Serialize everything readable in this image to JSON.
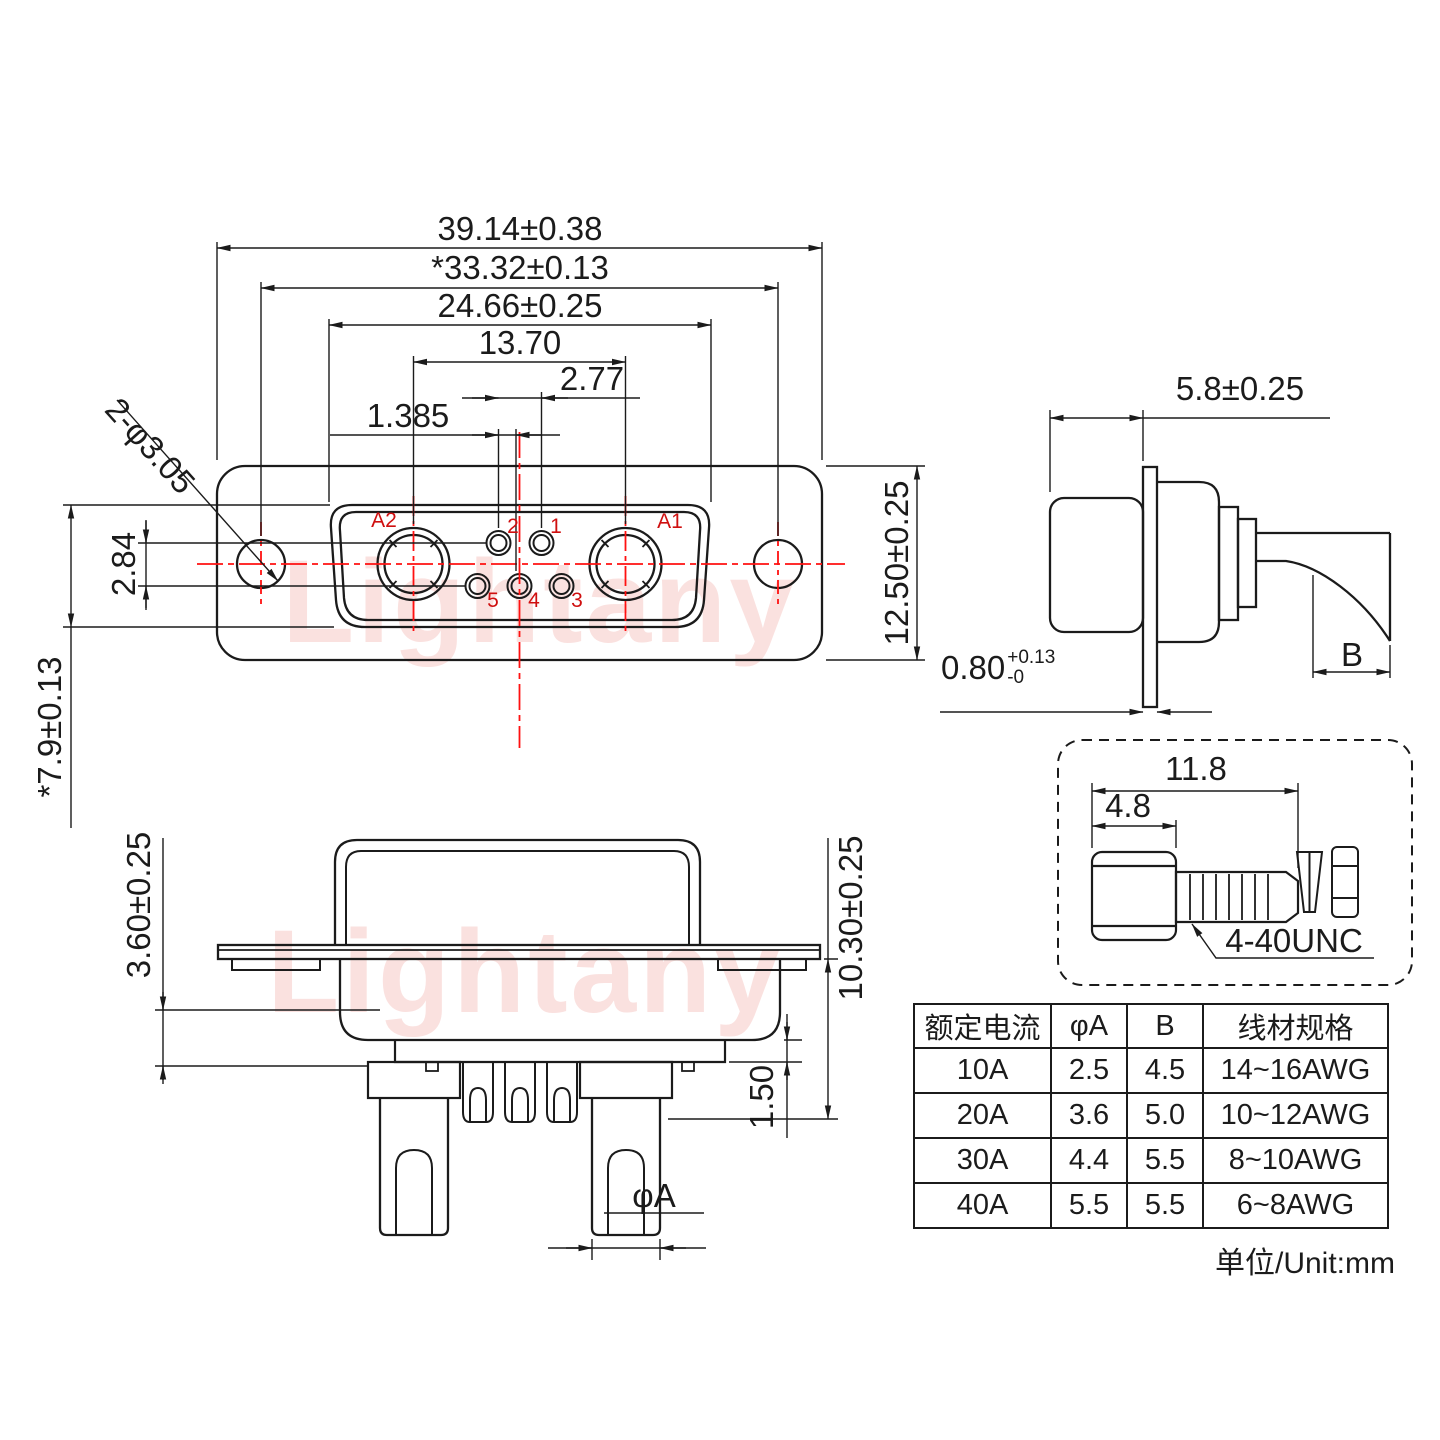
{
  "meta": {
    "watermark": "Lightany",
    "unit_note": "单位/Unit:mm"
  },
  "front_view": {
    "label_overall_width": "39.14±0.38",
    "label_mount_span": "*33.32±0.13",
    "label_shell_width": "24.66±0.25",
    "label_power_pitch": "13.70",
    "label_signal_pitch": "2.77",
    "label_signal_offset": "1.385",
    "label_mount_hole": "2-φ3.05",
    "label_row_gap": "2.84",
    "label_shell_height": "*7.9±0.13",
    "label_flange_height": "12.50±0.25",
    "pin_labels": {
      "a2": "A2",
      "a1": "A1",
      "p1": "1",
      "p2": "2",
      "p3": "3",
      "p4": "4",
      "p5": "5"
    }
  },
  "side_view": {
    "label_depth": "5.8±0.25",
    "label_flange_thickness": "0.80",
    "label_tol_plus": "+0.13",
    "label_tol_minus": "-0",
    "label_tail": "B"
  },
  "bottom_view": {
    "label_insulator_depth": "3.60±0.25",
    "label_total_depth": "10.30±0.25",
    "label_base_thickness": "1.50",
    "label_cup_dia": "φA"
  },
  "screw_detail": {
    "label_total_length": "11.8",
    "label_head_length": "4.8",
    "label_thread_spec": "4-40UNC"
  },
  "spec_table": {
    "headers": [
      "额定电流",
      "φA",
      "B",
      "线材规格"
    ],
    "rows": [
      [
        "10A",
        "2.5",
        "4.5",
        "14~16AWG"
      ],
      [
        "20A",
        "3.6",
        "5.0",
        "10~12AWG"
      ],
      [
        "30A",
        "4.4",
        "5.5",
        "8~10AWG"
      ],
      [
        "40A",
        "5.5",
        "5.5",
        "6~8AWG"
      ]
    ]
  }
}
